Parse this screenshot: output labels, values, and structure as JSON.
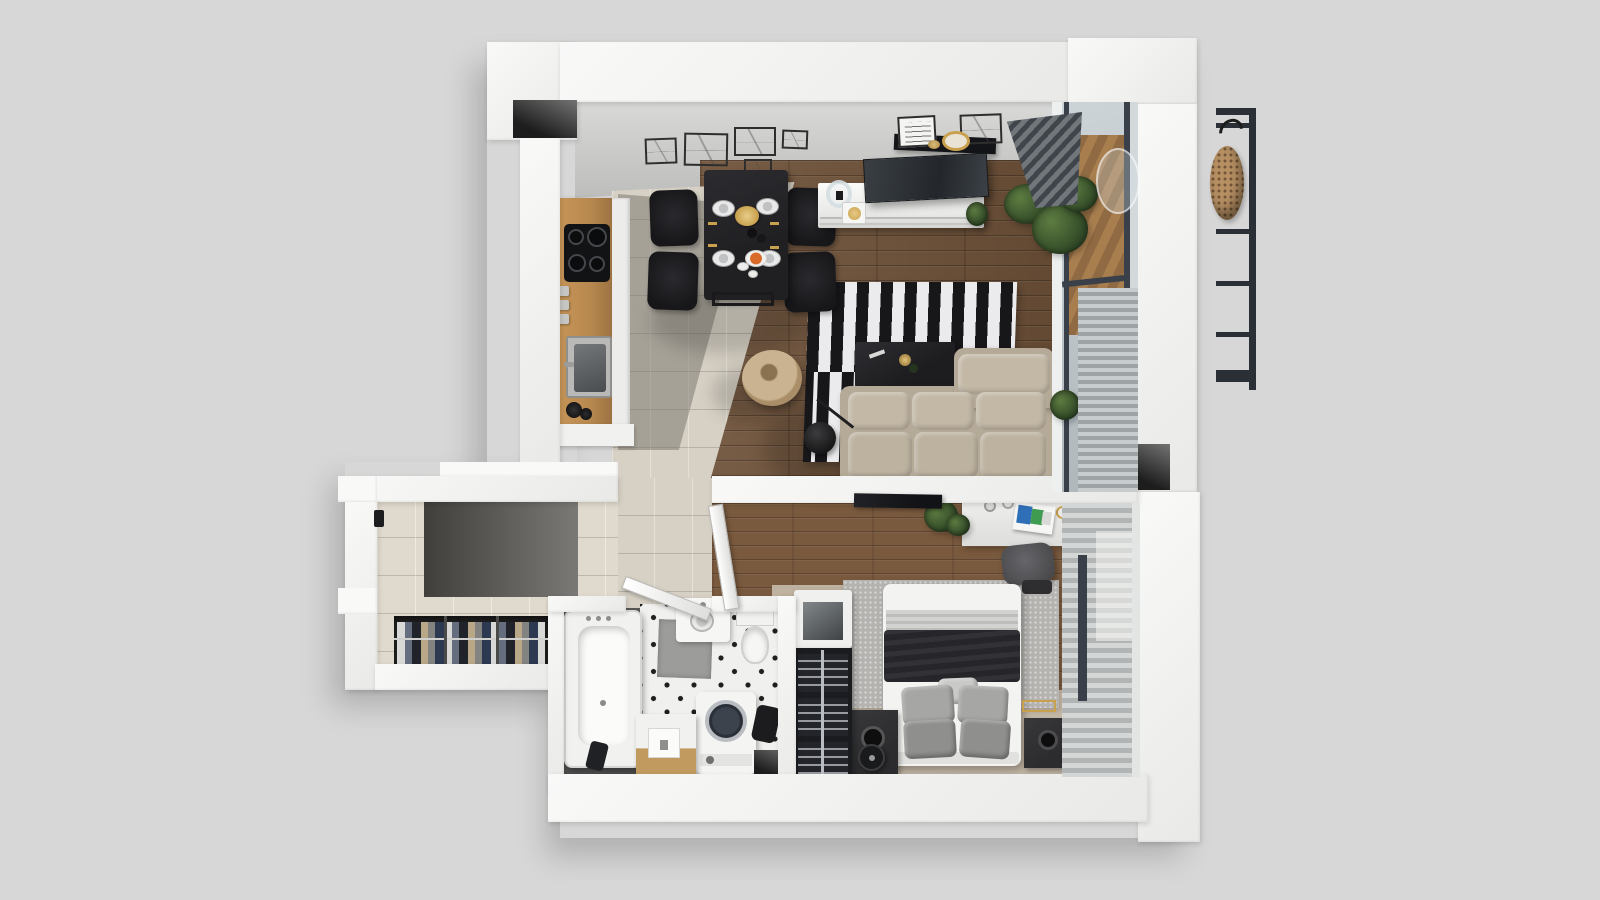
{
  "scene": {
    "type": "3d-floor-plan-top-down-render",
    "description": "Top-down 3D architectural render of a one-bedroom apartment on a light gray background",
    "rooms": [
      {
        "name": "kitchen-dining",
        "items": [
          "wooden counter",
          "induction cooktop",
          "sink",
          "black dining table",
          "4 black chairs",
          "table set with plates and gold cutlery",
          "wall art frames"
        ]
      },
      {
        "name": "living-room",
        "items": [
          "white tv console",
          "tv",
          "picture-ledge shelf",
          "black and white striped rug",
          "black coffee table",
          "beige corner sofa",
          "round wicker chair",
          "black floor lamp",
          "green plants",
          "glazed balcony wall with blinds"
        ]
      },
      {
        "name": "hallway",
        "items": [
          "entrance door handle",
          "dark entry tiles",
          "open wardrobe with hanging clothes"
        ]
      },
      {
        "name": "bathroom",
        "items": [
          "bathtub",
          "washbasin vanity",
          "toilet",
          "top-load washing machine",
          "wooden stool cabinet",
          "shower mat",
          "open door"
        ]
      },
      {
        "name": "bedroom",
        "items": [
          "double bed with dark blanket",
          "gray pillows",
          "gray rug",
          "speaker nightstands",
          "robot vacuum",
          "desk with magazines",
          "office chair",
          "wall tv",
          "shoe rack",
          "display cabinet",
          "window blinds"
        ]
      },
      {
        "name": "balcony-exterior",
        "items": [
          "metal railing",
          "hanging rattan egg chair",
          "wooden deck",
          "plants"
        ]
      }
    ]
  },
  "labels": {
    "floorPlan": "apartment floor plan",
    "kitchenCounter": "kitchen counter",
    "cooktop": "induction cooktop",
    "sink": "kitchen sink",
    "diningTable": "dining table",
    "diningChair": "dining chair",
    "plate": "place setting",
    "goldTray": "gold serving tray",
    "orangeDish": "orange dish",
    "tvConsole": "tv console",
    "tv": "television",
    "shelf": "picture ledge shelf",
    "pictureFrame": "picture frame",
    "mirror": "round gold mirror",
    "stripedRug": "black and white striped rug",
    "coffeeTable": "coffee table",
    "sofa": "corner sofa",
    "wickerChair": "round wicker chair",
    "floorLamp": "arc floor lamp",
    "plantLabel": "potted plant",
    "windowWall": "glazed balcony wall",
    "louvers": "venetian blinds",
    "deckLabel": "balcony wooden deck",
    "railing": "balcony railing",
    "eggChair": "hanging rattan egg chair",
    "partitionWall": "partition wall",
    "desk": "desk",
    "deskChair": "office chair",
    "magazines": "magazines",
    "bedroomTv": "wall-mounted tv",
    "bed": "double bed",
    "pillowLabel": "pillows",
    "bedRug": "bedroom rug",
    "nightstand": "speaker nightstand",
    "robotVacuum": "robot vacuum",
    "shoeRack": "shoe rack",
    "displayCabinet": "display cabinet",
    "wardrobe": "open wardrobe with clothes",
    "doorHandle": "entrance door handle",
    "bathtub": "bathtub",
    "toilet": "toilet",
    "vanity": "washbasin vanity",
    "washingMachine": "washing machine",
    "stoolCabinet": "stool cabinet",
    "showerMat": "shower mat",
    "bathroomDoor": "bathroom door",
    "bedroomDoor": "bedroom door",
    "wallNiche": "wall niche",
    "entryTiles": "entry floor tiles"
  },
  "palette": {
    "bg": "#d7d7d7",
    "wall": "#f9f9f8",
    "wallShade": "#e9e9e7",
    "wallFaceTop": "#dadad9",
    "wallFaceBottom": "#bdbdbb",
    "niche1": "#737373",
    "niche2": "#1d1d1d",
    "tile": "#d7d1c5",
    "entry1": "#413f3c",
    "entry2": "#7b7975",
    "wood1": "#6e5138",
    "wood2": "#7a5a3e",
    "deck": "#a87e4f",
    "rugBlack": "#17171a",
    "rugWhite": "#ebebed",
    "grayRug": "#b5b3b0",
    "sofa": "#b5aa98",
    "sofaCushion": "#c3b8a6",
    "tableBlack": "#202023",
    "chairBlack": "#17171a",
    "counterWood": "#b8894f",
    "cooktop": "#121315",
    "steel": "#6f7273",
    "gold": "#c9a14e",
    "orange": "#d96a2a",
    "plantDark": "#2f4726",
    "plantLight": "#5d7c41",
    "bedWhite": "#f3f3f1",
    "blanketDark": "#26262a",
    "blanketGray": "#d2d2d0",
    "pillowGray": "#a6a6a4",
    "nightstand": "#2c2c2e",
    "rack": "#1b1c1f",
    "bathDark": "#4c4c4c",
    "bathTile": "#f0f0ee",
    "mat": "#9c9c9a",
    "machine": "#f4f4f2",
    "lid": "#2b3038",
    "glass1": "#cdd4d8",
    "glass2": "#aeb6ba",
    "frameDark": "#39404a",
    "blind1": "#c8cccd",
    "blind2": "#9ea4a6",
    "blindLight1": "#d4d6d6",
    "blindLight2": "#b0b4b5",
    "wardrobeDark": "#242424",
    "rattan": "#b68f63",
    "railingDark": "#2a3036"
  }
}
